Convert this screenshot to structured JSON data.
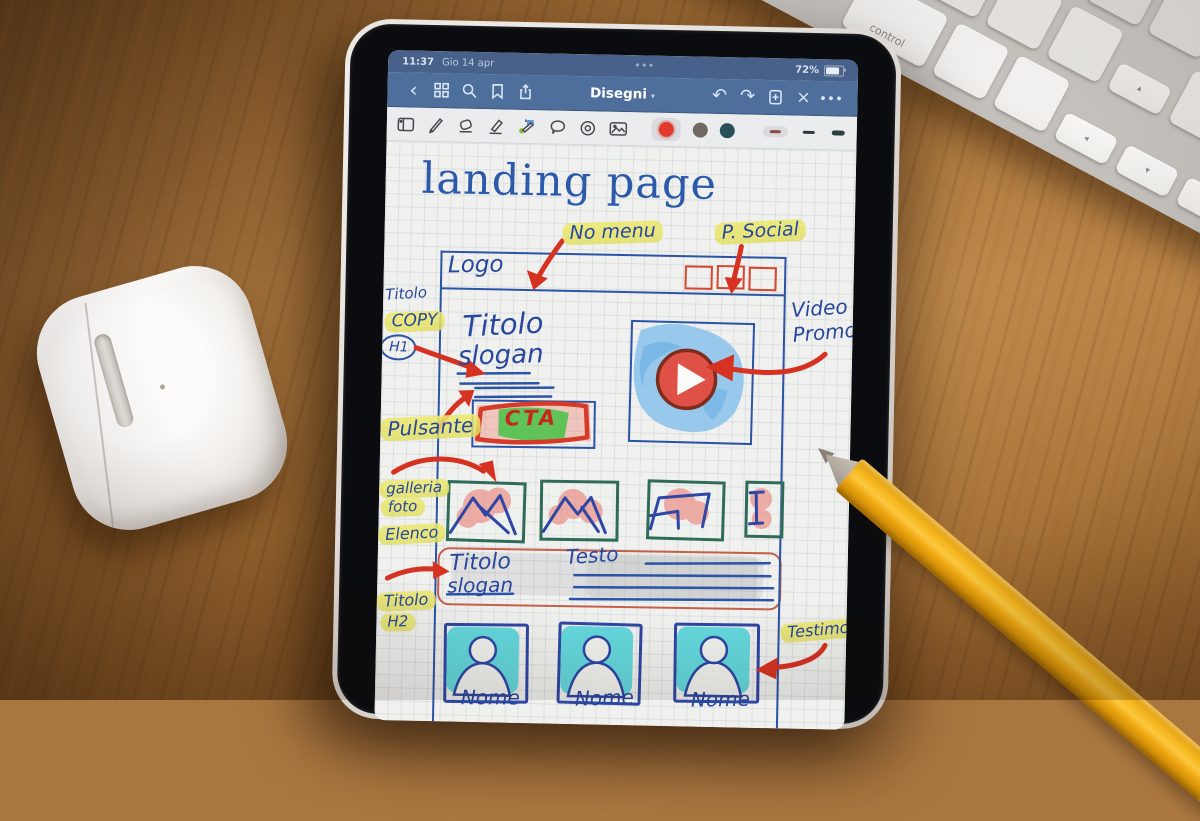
{
  "status_bar": {
    "time": "11:37",
    "date": "Gio 14 apr",
    "ellipsis": "•••",
    "battery_percent": "72%"
  },
  "nav_bar": {
    "back_glyph": "‹",
    "title": "Disegni",
    "title_caret": "▾",
    "undo_glyph": "↶",
    "redo_glyph": "↷",
    "close_glyph": "×",
    "more_glyph": "•••"
  },
  "toolbar": {
    "pen_colors": [
      "#e03b2c",
      "#6e6a60",
      "#29505a"
    ],
    "selected_color": "#e03b2c"
  },
  "sketch": {
    "page_title": "landing page",
    "no_menu": "No menu",
    "p_social": "P. Social",
    "logo": "Logo",
    "titolo_h1": "Titolo",
    "copy": "COPY",
    "h1": "H1",
    "hero_title": "Titolo",
    "hero_subtitle": "slogan",
    "cta": "CTA",
    "pulsante": "Pulsante",
    "video": "Video",
    "promo": "Promo",
    "galleria": "galleria",
    "foto": "foto",
    "elenco": "Elenco",
    "section_title": "Titolo",
    "section_subtitle": "slogan",
    "testo": "Testo",
    "titolo_h2": "Titolo",
    "h2": "H2",
    "nome_1": "Nome",
    "nome_2": "Nome",
    "nome_3": "Nome",
    "testimony": "Testimony"
  },
  "keyboard": {
    "control": "control",
    "arrow_left": "◂",
    "arrow_down": "▾",
    "arrow_right": "▸",
    "arrow_up": "▴"
  }
}
